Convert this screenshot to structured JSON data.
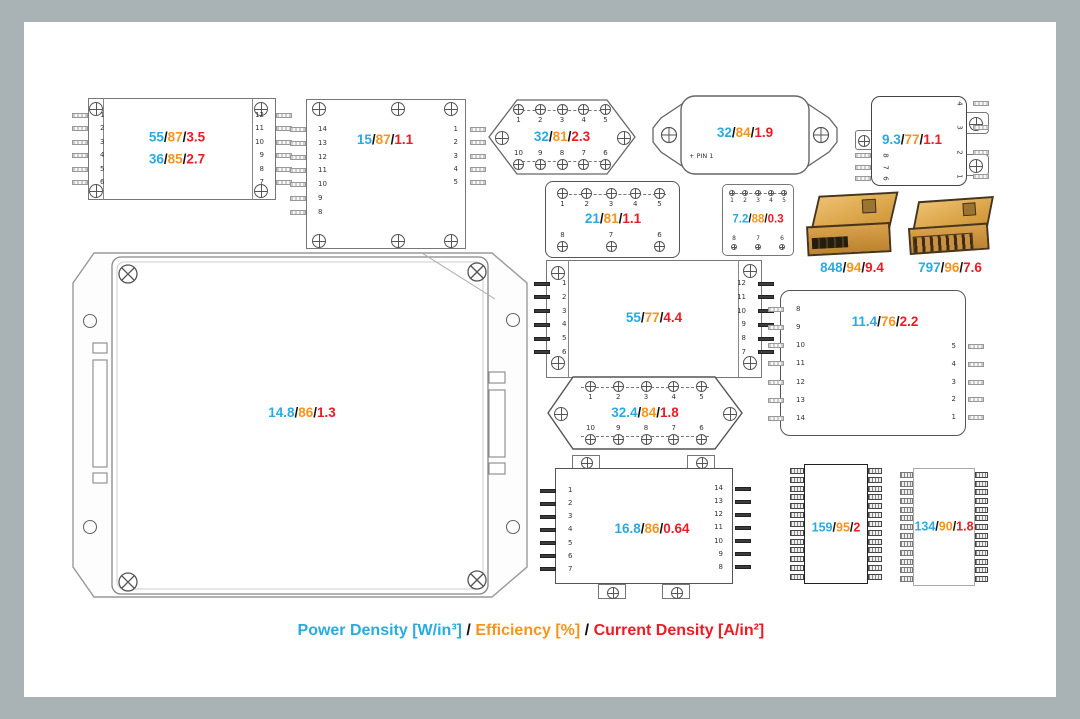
{
  "separator": "/",
  "colors": {
    "power": "#29ABE2",
    "efficiency": "#F7941D",
    "current": "#ED1C24",
    "frame": "#A9B2B5",
    "canvas": "#FFFFFF"
  },
  "legend": {
    "power": "Power Density [W/in³]",
    "sep": " / ",
    "efficiency": "Efficiency [%]",
    "sep2": " / ",
    "current": "Current Density [A/in²]"
  },
  "modules": {
    "m1": {
      "values": [
        {
          "pd": "55",
          "eff": "87",
          "cd": "3.5"
        },
        {
          "pd": "36",
          "eff": "85",
          "cd": "2.7"
        }
      ],
      "left_pins": [
        "1",
        "2",
        "3",
        "4",
        "5",
        "6"
      ],
      "right_pins": [
        "12",
        "11",
        "10",
        "9",
        "8",
        "7"
      ]
    },
    "m2": {
      "values": [
        {
          "pd": "15",
          "eff": "87",
          "cd": "1.1"
        }
      ],
      "left_pins": [
        "14",
        "13",
        "12",
        "11",
        "10",
        "9",
        "8"
      ],
      "right_pins": [
        "1",
        "2",
        "3",
        "4",
        "5"
      ]
    },
    "m3": {
      "values": [
        {
          "pd": "32",
          "eff": "81",
          "cd": "2.3"
        }
      ],
      "top_pins": [
        "1",
        "2",
        "3",
        "4",
        "5"
      ],
      "bottom_pins": [
        "10",
        "9",
        "8",
        "7",
        "6"
      ]
    },
    "m4": {
      "values": [
        {
          "pd": "32",
          "eff": "84",
          "cd": "1.9"
        }
      ],
      "pin1_label": "PIN 1"
    },
    "m5": {
      "values": [
        {
          "pd": "9.3",
          "eff": "77",
          "cd": "1.1"
        }
      ],
      "left_pins": [
        "8",
        "7",
        "6"
      ],
      "right_pins": [
        "4",
        "3",
        "2",
        "1"
      ]
    },
    "m6": {
      "values": [
        {
          "pd": "21",
          "eff": "81",
          "cd": "1.1"
        }
      ],
      "top_pins": [
        "1",
        "2",
        "3",
        "4",
        "5"
      ],
      "bottom_pins": [
        "8",
        "7",
        "6"
      ]
    },
    "m7": {
      "values": [
        {
          "pd": "7.2",
          "eff": "88",
          "cd": "0.3"
        }
      ],
      "top_pins": [
        "1",
        "2",
        "3",
        "4",
        "5"
      ],
      "bottom_pins": [
        "8",
        "7",
        "6"
      ]
    },
    "p1": {
      "values": [
        {
          "pd": "848",
          "eff": "94",
          "cd": "9.4"
        }
      ]
    },
    "p2": {
      "values": [
        {
          "pd": "797",
          "eff": "96",
          "cd": "7.6"
        }
      ]
    },
    "m8": {
      "values": [
        {
          "pd": "55",
          "eff": "77",
          "cd": "4.4"
        }
      ],
      "left_pins": [
        "1",
        "2",
        "3",
        "4",
        "5",
        "6"
      ],
      "right_pins": [
        "12",
        "11",
        "10",
        "9",
        "8",
        "7"
      ]
    },
    "m9": {
      "values": [
        {
          "pd": "11.4",
          "eff": "76",
          "cd": "2.2"
        }
      ],
      "left_pins": [
        "8",
        "9",
        "10",
        "11",
        "12",
        "13",
        "14"
      ],
      "right_pins": [
        "5",
        "4",
        "3",
        "2",
        "1"
      ]
    },
    "mBig": {
      "values": [
        {
          "pd": "14.8",
          "eff": "86",
          "cd": "1.3"
        }
      ]
    },
    "mJ": {
      "values": [
        {
          "pd": "32.4",
          "eff": "84",
          "cd": "1.8"
        }
      ],
      "top_pins": [
        "1",
        "2",
        "3",
        "4",
        "5"
      ],
      "bottom_pins": [
        "10",
        "9",
        "8",
        "7",
        "6"
      ]
    },
    "m10": {
      "values": [
        {
          "pd": "16.8",
          "eff": "86",
          "cd": "0.64"
        }
      ],
      "left_pins": [
        "1",
        "2",
        "3",
        "4",
        "5",
        "6",
        "7"
      ],
      "right_pins": [
        "14",
        "13",
        "12",
        "11",
        "10",
        "9",
        "8"
      ]
    },
    "m11": {
      "values": [
        {
          "pd": "159",
          "eff": "95",
          "cd": "2"
        }
      ]
    },
    "m12": {
      "values": [
        {
          "pd": "134",
          "eff": "90",
          "cd": "1.8"
        }
      ]
    }
  }
}
